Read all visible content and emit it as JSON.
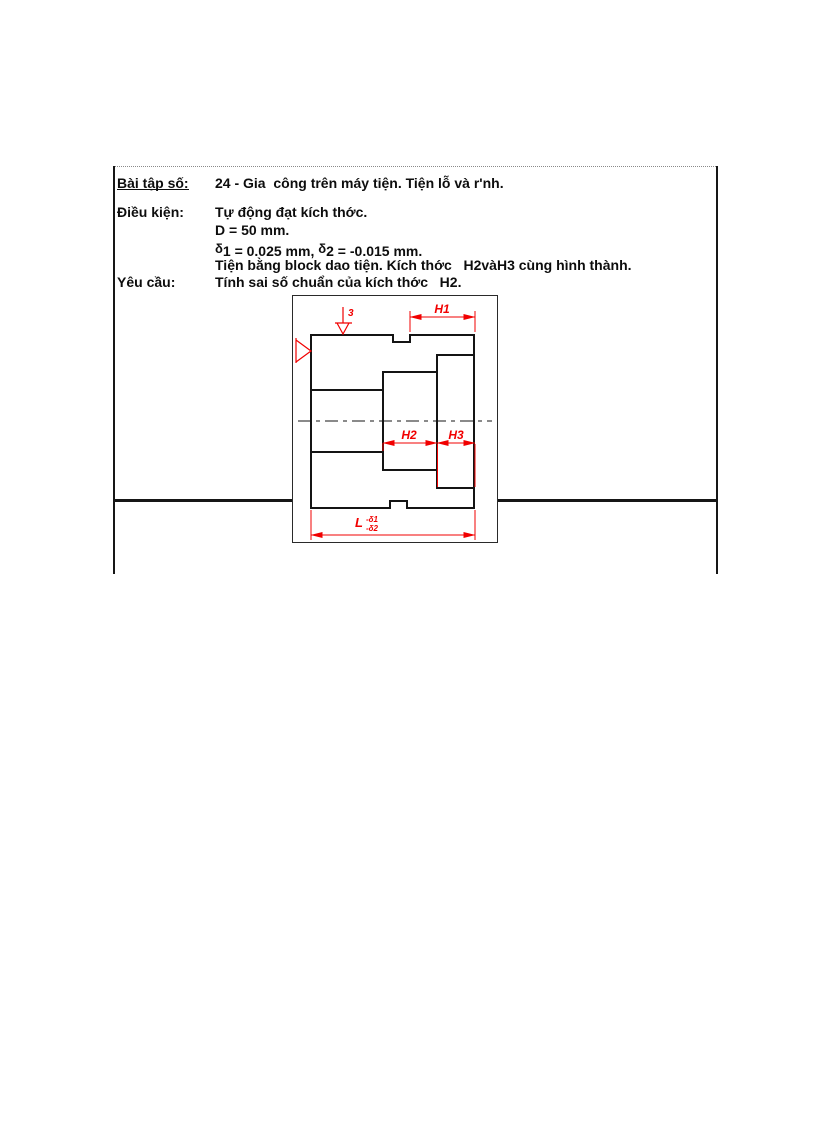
{
  "table": {
    "row1_label": "Bài tập số:",
    "row1_value": "24 - Gia  công trên máy tiện. Tiện lỗ và r'nh.",
    "row2_label": "Điều kiện:",
    "cond": {
      "line1": "Tự động đạt kích thớc.",
      "line2": "D = 50 mm.",
      "d1_sym": "δ",
      "d1_text": "1 = 0.025 mm, ",
      "d2_sym": "δ",
      "d2_text": "2 = -0.015 mm.",
      "line4": "Tiện bằng block dao tiện. Kích thớc   H2vàH3 cùng hình thành."
    },
    "row3_label": "Yêu cầu:",
    "row3_value": "Tính sai số chuẩn của kích thớc   H2."
  },
  "drawing": {
    "dim_h1": "H1",
    "dim_h2": "H2",
    "dim_h3": "H3",
    "dim_l": "L",
    "l_tol_upper": "-δ1",
    "l_tol_lower": "-δ2",
    "finish_grade": "3"
  },
  "colors": {
    "dimension_red": "#f10000",
    "line_black": "#141414"
  }
}
